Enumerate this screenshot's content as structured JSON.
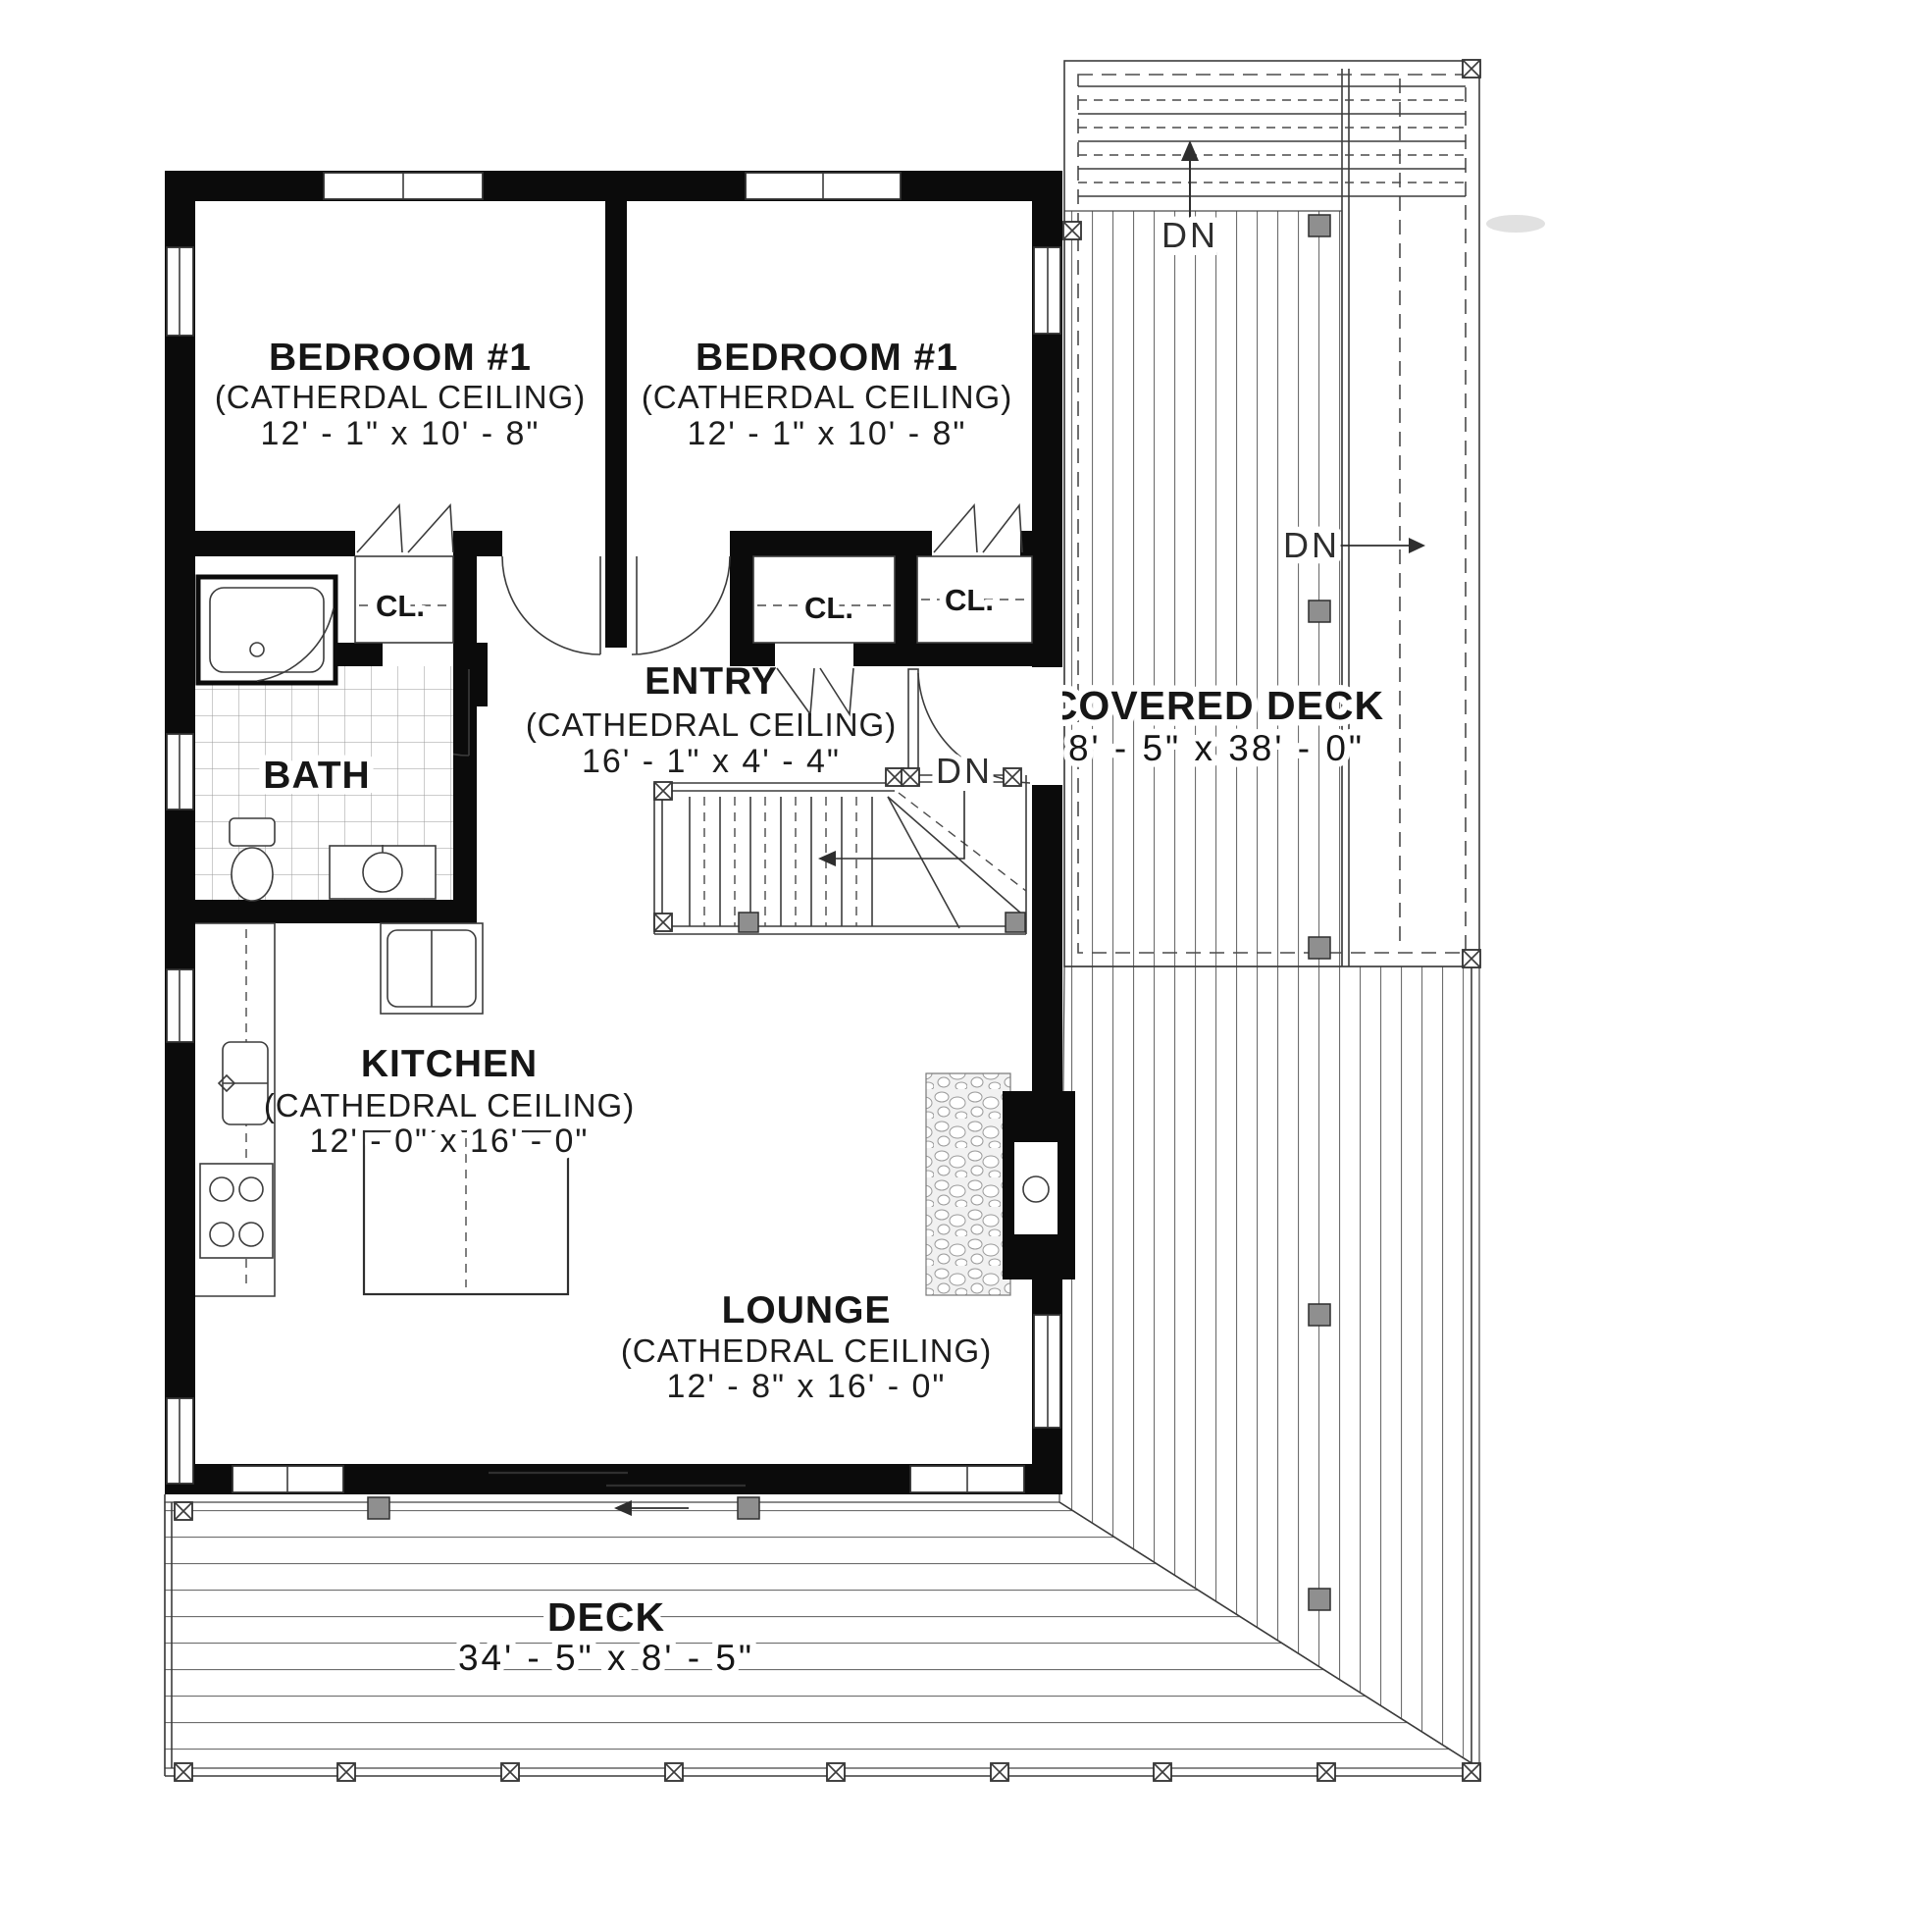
{
  "document": {
    "type": "floor-plan"
  },
  "colors": {
    "wall": "#0b0b0b",
    "plank_line": "#6e6e6e",
    "post_gray": "#8f8f8f",
    "text": "#161616",
    "background": "#ffffff"
  },
  "labels": {
    "closet": "CL.",
    "down": "DN"
  },
  "rooms": {
    "bedroom_left": {
      "name": "BEDROOM #1",
      "ceiling": "(CATHERDAL CEILING)",
      "size": "12' - 1\" x 10' - 8\""
    },
    "bedroom_right": {
      "name": "BEDROOM #1",
      "ceiling": "(CATHERDAL CEILING)",
      "size": "12' - 1\" x 10' - 8\""
    },
    "entry": {
      "name": "ENTRY",
      "ceiling": "(CATHEDRAL CEILING)",
      "size": "16' - 1\" x 4' - 4\""
    },
    "bath": {
      "name": "BATH"
    },
    "kitchen": {
      "name": "KITCHEN",
      "ceiling": "(CATHEDRAL CEILING)",
      "size": "12' - 0\" x 16' - 0\""
    },
    "lounge": {
      "name": "LOUNGE",
      "ceiling": "(CATHEDRAL CEILING)",
      "size": "12' - 8\" x 16' - 0\""
    },
    "covered_deck": {
      "name": "COVERED DECK",
      "size": "8' - 5\" x 38' - 0\""
    },
    "deck": {
      "name": "DECK",
      "size": "34' - 5\" x 8' - 5\""
    }
  }
}
